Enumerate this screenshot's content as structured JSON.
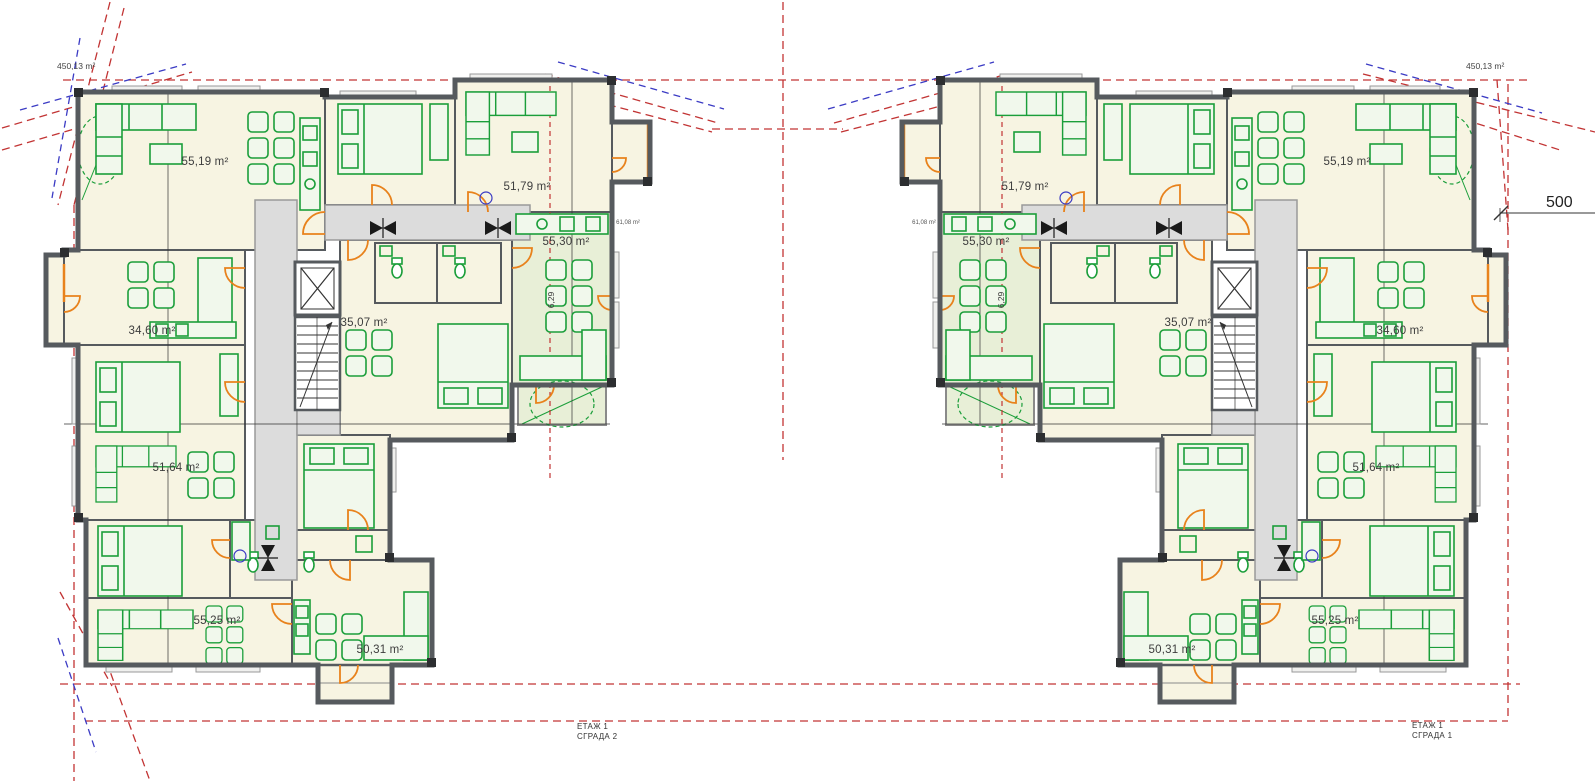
{
  "site": {
    "plot_area_left": "450,13 m²",
    "plot_area_right": "450,13 m²",
    "dimension_width": "500",
    "common_area_left": "61,08 m²",
    "common_area_right": "61,08 m²"
  },
  "buildings": [
    {
      "title_floor": "ЕТАЖ 1",
      "title_name": "СГРАДА 2",
      "apartments": {
        "top_left": "55,19 m²",
        "top_right": "51,79 m²",
        "right_wing": "55,30 m²",
        "right_wing_balcony": "6,29",
        "mid_left": "34,60 m²",
        "mid_center": "35,07 m²",
        "lower_left": "51,64 m²",
        "bottom_left": "55,25 m²",
        "bottom_right": "50,31 m²"
      }
    },
    {
      "title_floor": "ЕТАЖ 1",
      "title_name": "СГРАДА 1",
      "apartments": {
        "top_left": "55,19 m²",
        "top_right": "51,79 m²",
        "right_wing": "55,30 m²",
        "right_wing_balcony": "6,29",
        "mid_left": "34,60 m²",
        "mid_center": "35,07 m²",
        "lower_left": "51,64 m²",
        "bottom_left": "55,25 m²",
        "bottom_right": "50,31 m²"
      }
    }
  ],
  "colors": {
    "wall": "#565a5e",
    "wall_dark": "#2c2e30",
    "furniture": "#1b9e3a",
    "furniture_fill": "#f1f8ec",
    "door": "#e8821c",
    "site_red": "#c23434",
    "site_blue": "#3b3bc4",
    "room_cream": "#f7f4e2",
    "room_green": "#e8efd7",
    "corridor": "#dcdcdc",
    "axis": "#333333"
  }
}
